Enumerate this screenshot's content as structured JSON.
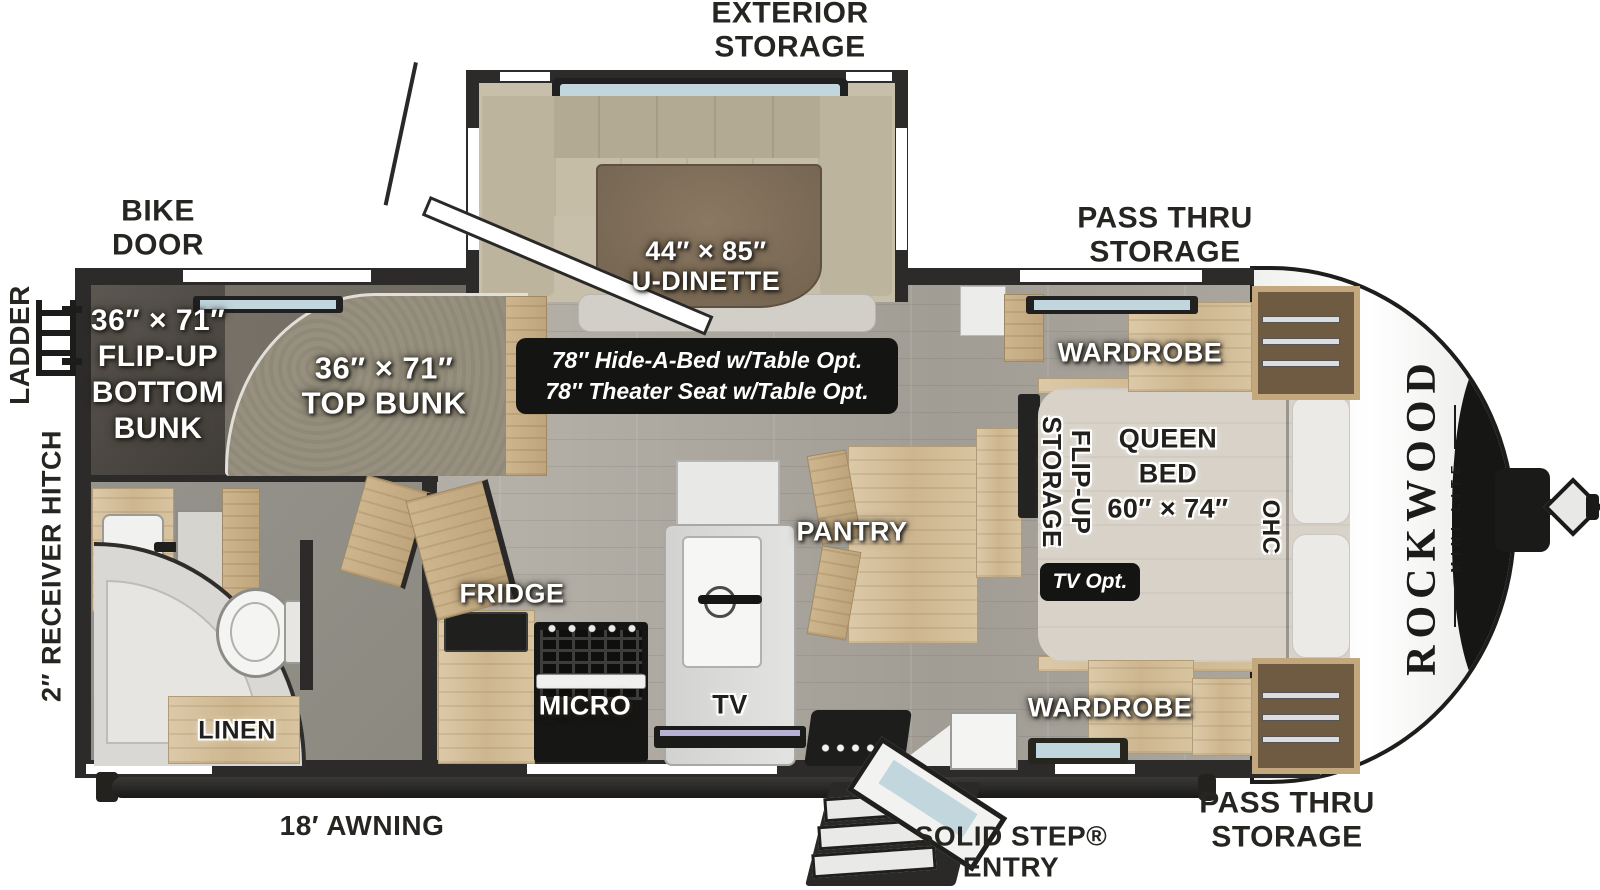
{
  "floorplan": {
    "brand": {
      "name": "ROCKWOOD",
      "series": "MINI LITE"
    },
    "exterior_labels": {
      "exterior_storage": [
        "EXTERIOR",
        "STORAGE"
      ],
      "bike_door": [
        "BIKE",
        "DOOR"
      ],
      "pass_thru_storage_top": [
        "PASS THRU",
        "STORAGE"
      ],
      "pass_thru_storage_bottom": [
        "PASS THRU",
        "STORAGE"
      ],
      "ladder": "LADDER",
      "receiver_hitch": "2″ RECEIVER HITCH",
      "awning": "18′ AWNING",
      "solid_step_entry": [
        "SOLID STEP®",
        "ENTRY"
      ]
    },
    "interior_labels": {
      "flip_up_bottom_bunk": [
        "36″ × 71″",
        "FLIP-UP",
        "BOTTOM",
        "BUNK"
      ],
      "top_bunk": [
        "36″ × 71″",
        "TOP BUNK"
      ],
      "u_dinette": [
        "44″ × 85″",
        "U-DINETTE"
      ],
      "options_badge": [
        "78″ Hide-A-Bed w/Table Opt.",
        "78″ Theater Seat w/Table Opt."
      ],
      "wardrobe_top": "WARDROBE",
      "wardrobe_bottom": "WARDROBE",
      "flip_up_storage": [
        "FLIP-UP",
        "STORAGE"
      ],
      "queen_bed": [
        "QUEEN",
        "BED",
        "60″ × 74″"
      ],
      "ohc": "OHC",
      "tv_opt": "TV Opt.",
      "pantry": "PANTRY",
      "fridge": "FRIDGE",
      "micro": "MICRO",
      "tv": "TV",
      "linen": "LINEN"
    },
    "colors": {
      "wall": "#2c2b29",
      "floor_wood": "#aba79f",
      "cabinet_wood": "#d2bd97",
      "badge_black": "#141412",
      "dinette_cushion": "#b3aa93",
      "dinette_table": "#7c6a55",
      "mattress": "#d8d2c8",
      "cap_white": "#ffffff",
      "glass_blue": "#c2d6de"
    }
  }
}
